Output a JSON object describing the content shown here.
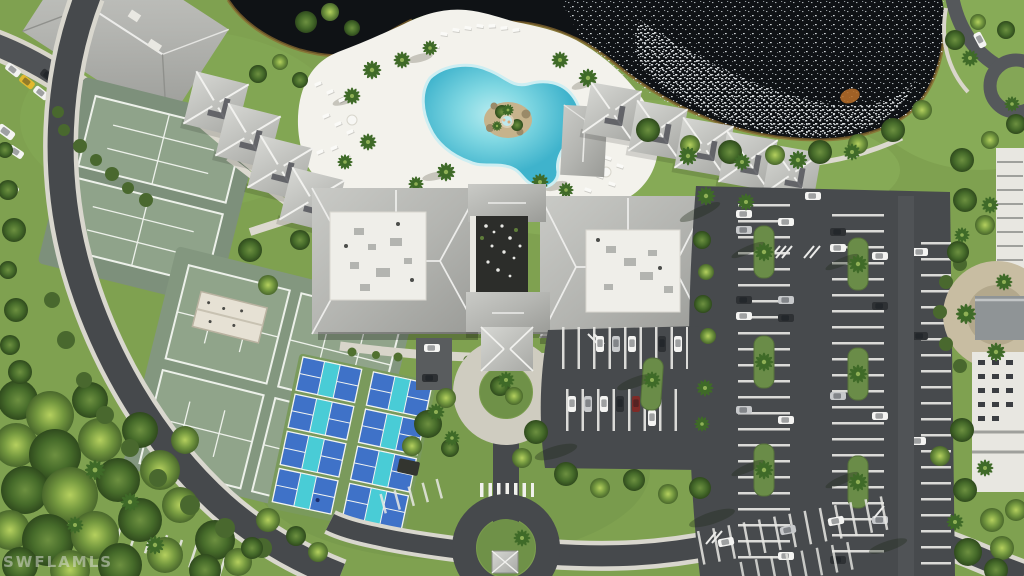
{
  "meta": {
    "type": "aerial-photograph",
    "description": "Overhead drone view of a resort community amenity campus: lagoon-style pool with rock island beside a dark lake, large clubhouse with gray hip roofs, six tennis courts, eight blue pickleball courts, bocce lanes, two rows of pyramid-roof cabanas, entry drive with porte-cochere, roundabout with gazebo, and landscaped parking lots"
  },
  "watermark": {
    "text": "SWFLAMLS"
  },
  "scene": {
    "lake": "lake with sun glitter",
    "pool": "lagoon pool with rock island and spa",
    "tennis_courts": 6,
    "pickleball_courts": 8,
    "bocce_lanes": 2,
    "cabanas": 9,
    "roundabout": "roundabout with gazebo",
    "parking": "striped parking lots with cars"
  },
  "palette": {
    "grass": "#7fa150",
    "canopy_bright": "#a9c855",
    "canopy_dark": "#3c5a26",
    "lake": "#0f1215",
    "shoreline": "#8a6a2f",
    "asphalt": "#474a4d",
    "concrete": "#d7d4c9",
    "pool_deck": "#f3f2ec",
    "pool_water": "#4fbdd2",
    "roof_gray": "#b9bab6",
    "roof_white": "#efeee8",
    "courtyard": "#2c2d2a",
    "tennis_surround": "#7d907b",
    "tennis_court": "#8fa38a",
    "pb_apron": "#7a9a5c",
    "pb_court": "#3f72c8",
    "pb_kitchen": "#49ccd6",
    "car_yellow": "#e2b92f",
    "car_red": "#7e2b28",
    "plaza_tan": "#c8bda2"
  }
}
